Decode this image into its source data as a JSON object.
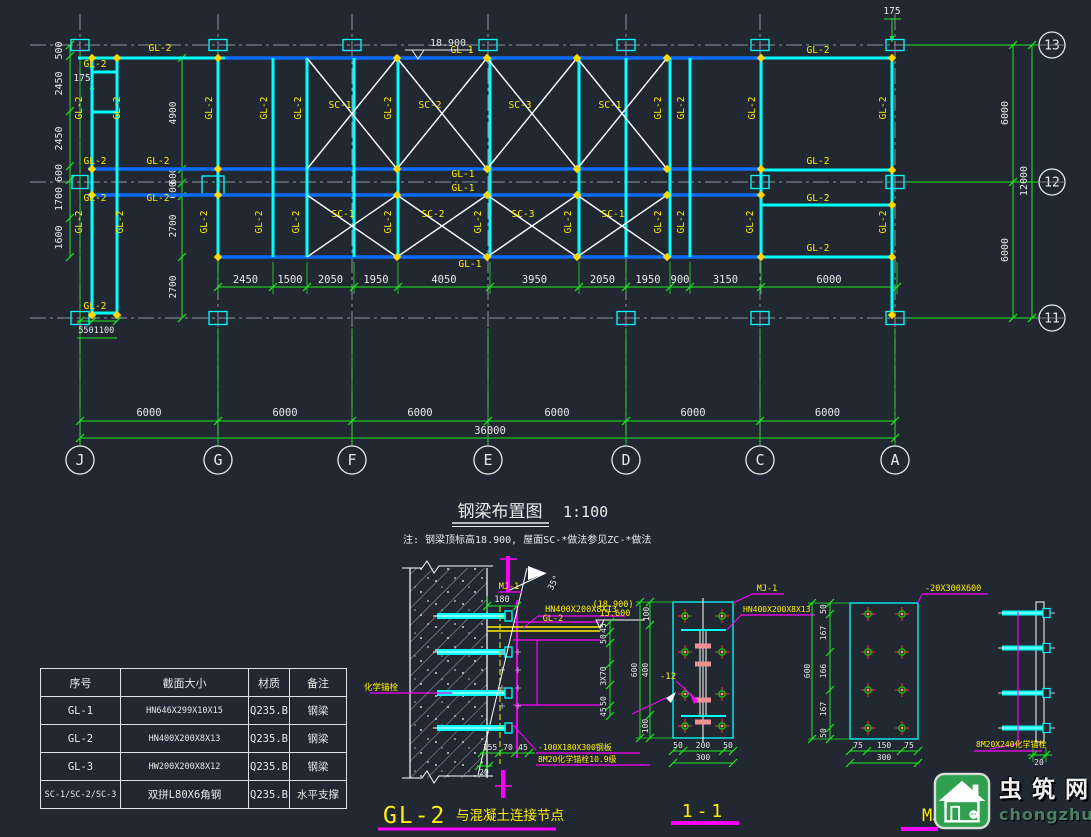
{
  "plan": {
    "title": "钢梁布置图",
    "scale": "1:100",
    "note": "注: 钢梁顶标高18.900, 屋面SC-*做法参见ZC-*做法",
    "elevation": "18.900",
    "grid_rows": [
      "13",
      "12",
      "11"
    ],
    "grid_cols": [
      "J",
      "G",
      "F",
      "E",
      "D",
      "C",
      "A"
    ],
    "dims_bottom": [
      "6000",
      "6000",
      "6000",
      "6000",
      "6000",
      "6000"
    ],
    "dim_total": "36000",
    "dims_mid": [
      "2450",
      "1500",
      "2050",
      "1950",
      "4050",
      "3950",
      "2050",
      "1950",
      "900",
      "3150",
      "6000"
    ],
    "dims_left": [
      "500",
      "2450",
      "2450",
      "600",
      "1700",
      "1600"
    ],
    "dims_inner_left": [
      "4900",
      "600",
      "600",
      "2700",
      "2700"
    ],
    "dims_left_bottom": [
      "550",
      "1100"
    ],
    "dims_right": [
      "6000",
      "6000",
      "12000"
    ],
    "offset_left": "175",
    "offset_top": "175",
    "label_gl1": "GL-1",
    "label_gl2": "GL-2",
    "braces": [
      "SC-1",
      "SC-2",
      "SC-3",
      "SC-1"
    ]
  },
  "legend_table": {
    "headers": [
      "序号",
      "截面大小",
      "材质",
      "备注"
    ],
    "rows": [
      [
        "GL-1",
        "HN646X299X10X15",
        "Q235.B",
        "钢梁"
      ],
      [
        "GL-2",
        "HN400X200X8X13",
        "Q235.B",
        "钢梁"
      ],
      [
        "GL-3",
        "HW200X200X8X12",
        "Q235.B",
        "钢梁"
      ],
      [
        "SC-1/SC-2/SC-3",
        "双拼L80X6角钢",
        "Q235.B",
        "水平支撑"
      ]
    ]
  },
  "detail_a": {
    "title_main": "GL-2",
    "title_rest": "与混凝土连接节点",
    "mj": "MJ-1",
    "beam_spec": "HN400X200X8X13",
    "beam_name": "GL-2",
    "elev_paren": "(18.900)",
    "elev": "15.600",
    "angle": "35°",
    "anchor": "化学锚栓",
    "plate_note": "-100X180X300钢板",
    "anchor_note": "8M20化学锚栓10.9级",
    "dim_180": "180",
    "dims_right": [
      "45",
      "50",
      "3X70",
      "50",
      "45"
    ],
    "dims_bottom": [
      "155",
      "70",
      "45"
    ],
    "dim_20": "20"
  },
  "detail_b": {
    "title": "1-1",
    "mj": "MJ-1",
    "beam_spec": "HN400X200X8X13",
    "plate": "-12",
    "dims_left": [
      "100",
      "400",
      "100"
    ],
    "dim_total_left": "600",
    "dims_bottom": [
      "50",
      "200",
      "50"
    ],
    "dim_total_bottom": "300"
  },
  "detail_c": {
    "title": "MJ-1",
    "plate": "-20X300X600",
    "dims_left": [
      "50",
      "167",
      "166",
      "167",
      "50"
    ],
    "dim_total_left": "600",
    "dims_bottom": [
      "75",
      "150",
      "75"
    ],
    "dim_total_bottom": "300"
  },
  "detail_d": {
    "label": "8M20X240化学锚栓",
    "dim": "20"
  },
  "watermark": {
    "name": "虫筑网",
    "domain": "chongzhu.cn"
  }
}
